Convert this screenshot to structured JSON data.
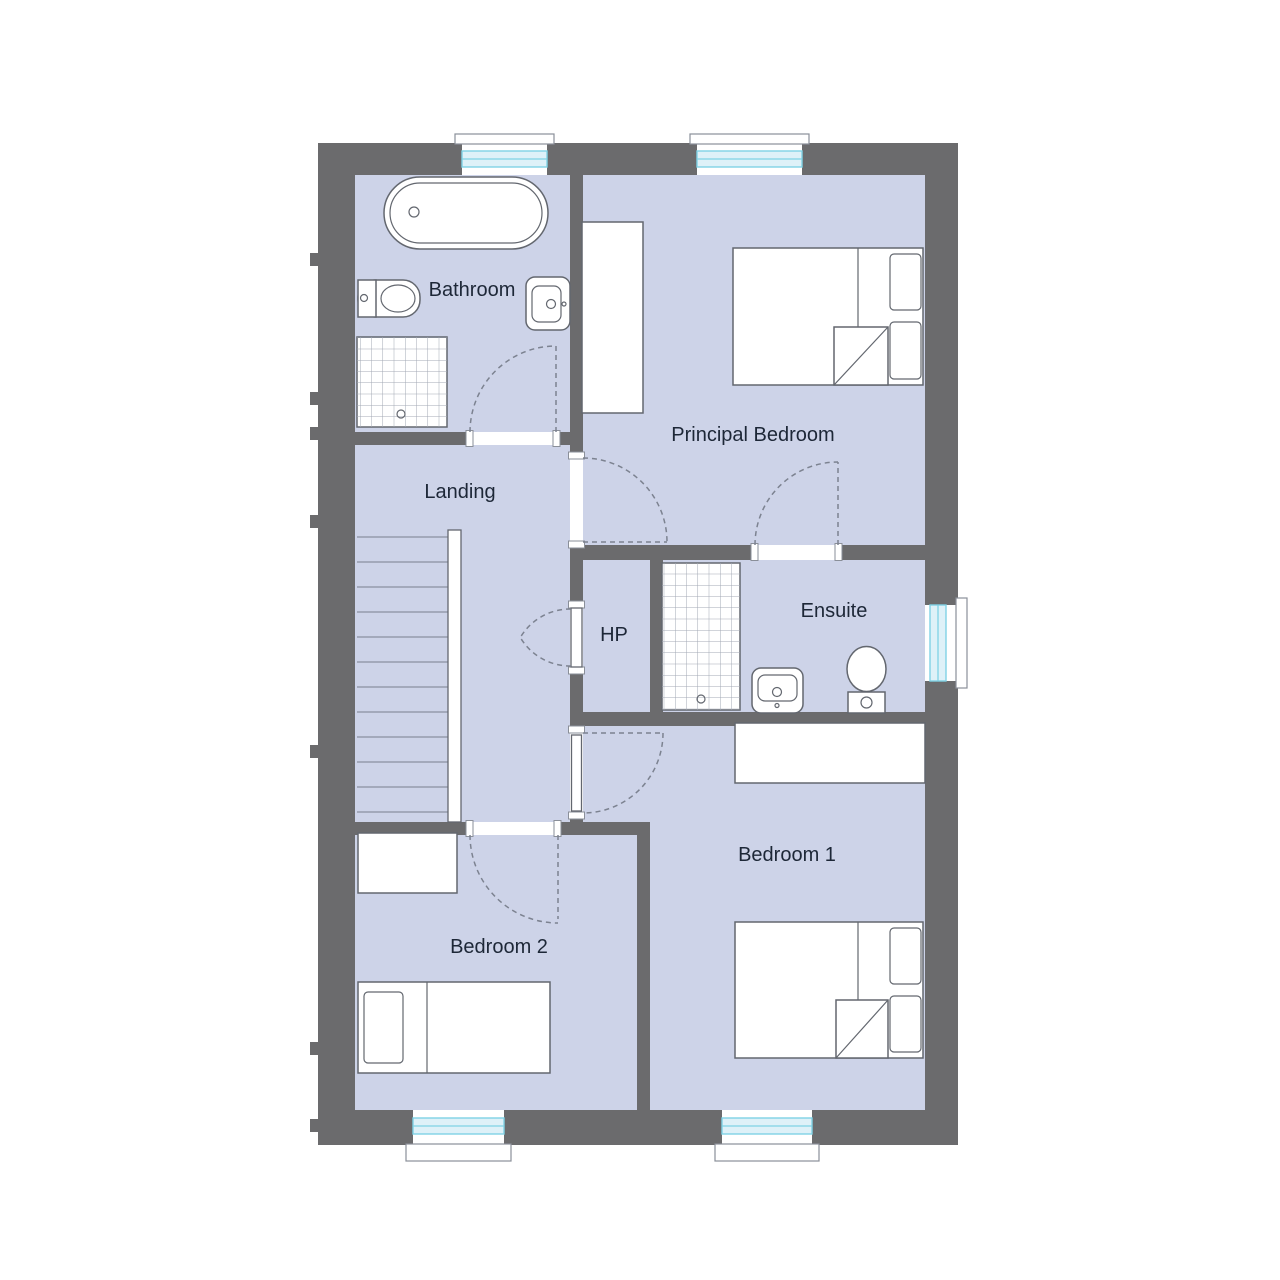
{
  "plan": {
    "rooms": {
      "bathroom": {
        "label": "Bathroom"
      },
      "landing": {
        "label": "Landing"
      },
      "hp": {
        "label": "HP"
      },
      "principal_bedroom": {
        "label": "Principal Bedroom"
      },
      "ensuite": {
        "label": "Ensuite"
      },
      "bedroom_1": {
        "label": "Bedroom 1"
      },
      "bedroom_2": {
        "label": "Bedroom 2"
      }
    },
    "fixtures": {
      "bathroom": [
        "bathtub-icon",
        "toilet-icon",
        "sink-icon",
        "shower-icon"
      ],
      "ensuite": [
        "shower-icon",
        "sink-icon",
        "toilet-icon"
      ],
      "principal_bedroom": [
        "double-bed-icon",
        "wardrobe-icon"
      ],
      "bedroom_1": [
        "double-bed-icon",
        "wardrobe-icon"
      ],
      "bedroom_2": [
        "single-bed-icon",
        "wardrobe-icon"
      ],
      "landing": [
        "staircase-icon"
      ]
    },
    "colors": {
      "wall": "#6b6b6d",
      "floor": "#cdd3e8",
      "fixture_outline": "#63676f",
      "stair_line": "#8a90a0",
      "door_dash": "#7c8290",
      "glass_fill": "#def1f8",
      "glass_line": "#7fd2e5",
      "label_text": "#1d2737",
      "frame_outline": "#8a8f99",
      "grid_line": "#a2a8b4"
    }
  }
}
